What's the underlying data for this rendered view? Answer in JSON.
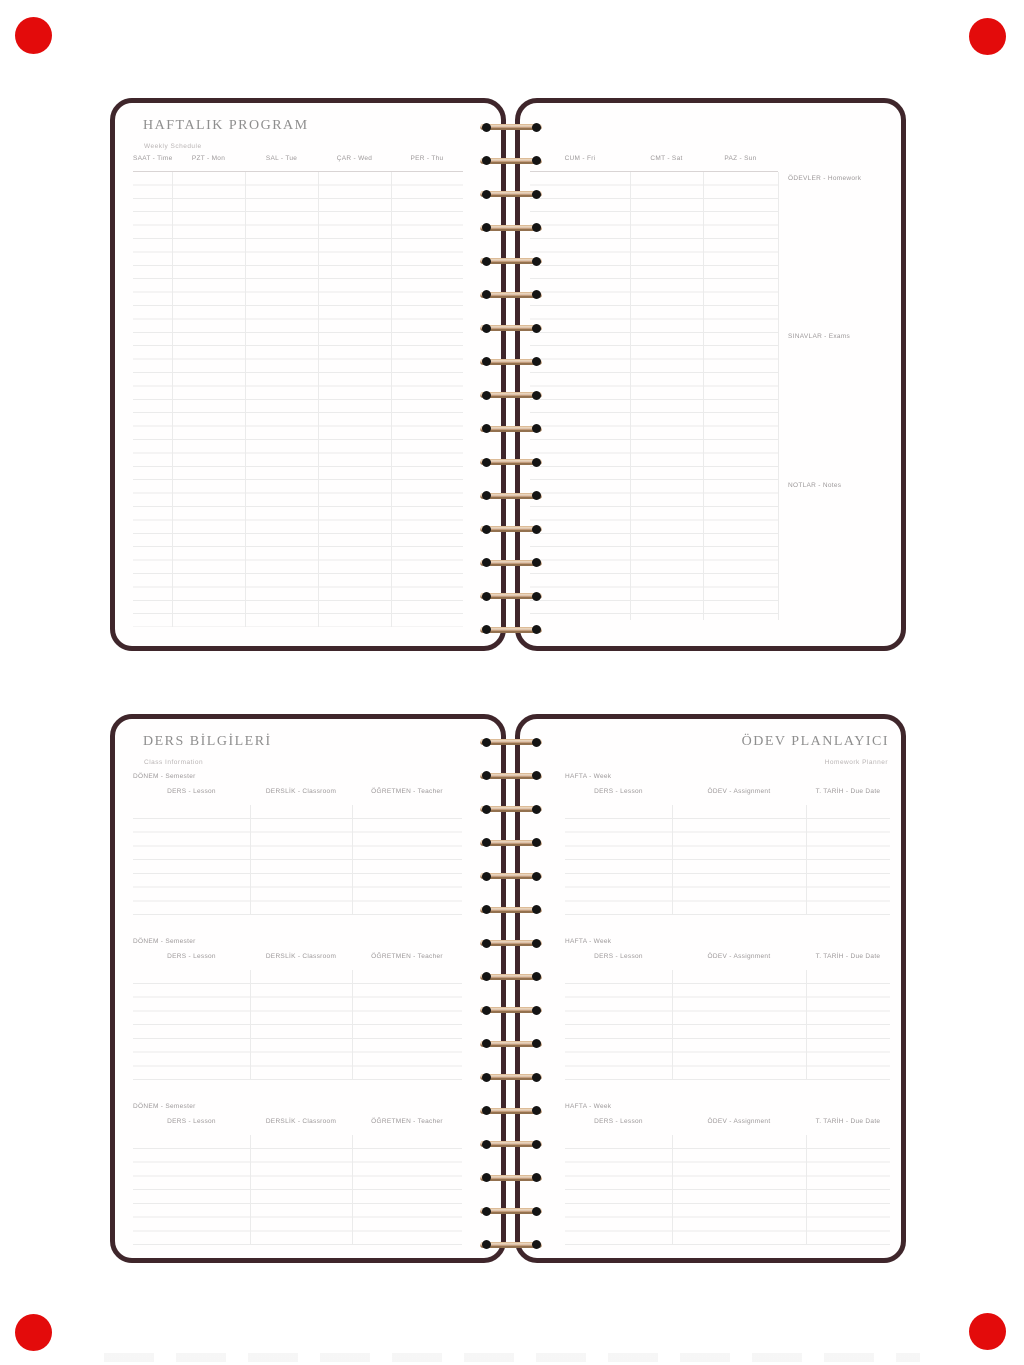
{
  "colors": {
    "cover": "#3f262b",
    "wire": "#c8a183",
    "hole": "#141414",
    "marker_red": "#e30b0b",
    "line": "#ebebeb",
    "title_gray": "#8e8e8e"
  },
  "weekly_left": {
    "title": "HAFTALIK PROGRAM",
    "subtitle": "Weekly Schedule",
    "time_header": "SAAT - Time",
    "day_headers": [
      "PZT - Mon",
      "SAL - Tue",
      "ÇAR - Wed",
      "PER - Thu"
    ]
  },
  "weekly_right": {
    "day_headers": [
      "CUM - Fri",
      "CMT - Sat",
      "PAZ - Sun"
    ],
    "side_sections": [
      "ÖDEVLER - Homework",
      "SINAVLAR - Exams",
      "NOTLAR - Notes"
    ]
  },
  "lesson_info": {
    "title": "DERS BİLGİLERİ",
    "subtitle": "Class Information",
    "sections": [
      "DÖNEM - Semester",
      "DÖNEM - Semester",
      "DÖNEM - Semester"
    ],
    "columns": [
      "DERS - Lesson",
      "DERSLİK - Classroom",
      "ÖĞRETMEN - Teacher"
    ]
  },
  "homework_planner": {
    "title": "ÖDEV PLANLAYICI",
    "subtitle": "Homework Planner",
    "sections": [
      "HAFTA - Week",
      "HAFTA - Week",
      "HAFTA - Week"
    ],
    "columns": [
      "DERS - Lesson",
      "ÖDEV - Assignment",
      "T. TARİH - Due Date"
    ]
  }
}
